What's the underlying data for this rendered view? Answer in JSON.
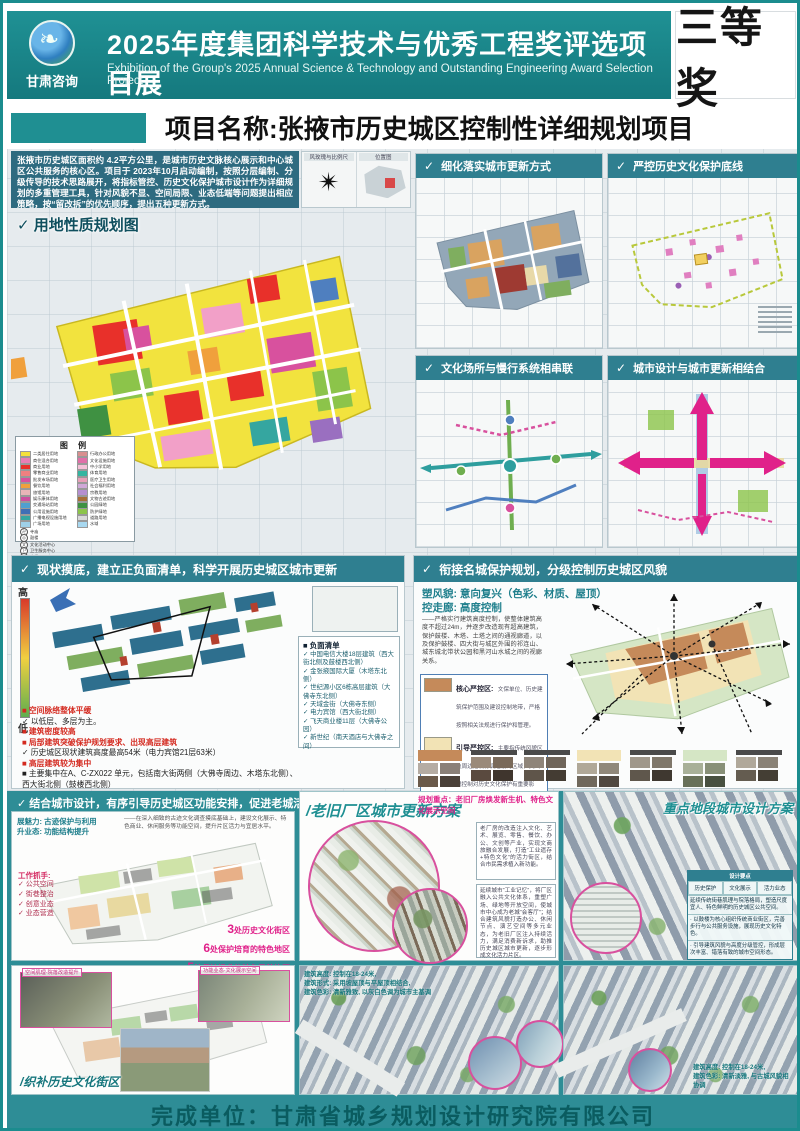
{
  "ui": {
    "check": "✓",
    "slash": "/"
  },
  "header": {
    "logo_text": "甘肃咨询",
    "title": "2025年度集团科学技术与优秀工程奖评选项目展",
    "subtitle": "Exhibition of the Group's 2025 Annual Science & Technology and Outstanding Engineering Award Selection Project",
    "award": "三等奖"
  },
  "project": {
    "title": "项目名称:张掖市历史城区控制性详细规划项目",
    "intro": "张掖市历史城区面积约 4.2平方公里，是城市历史文脉核心展示和中心城区公共服务的核心区。项目于 2023年10月启动编制，按照分层编制、分级传导的技术思路展开，将指标管控、历史文化保护城市设计作为详细规划的多重管理工具，针对风貌不显、空间局限、业态低端等问题提出相应策略，按“留改拆”的优先顺序，提出五种更新方式。",
    "windrose_label": "风玫瑰与比例尺",
    "location_label": "位置图"
  },
  "land_use": {
    "title": "用地性质规划图",
    "legend_title": "图 例",
    "legend_left": [
      {
        "color": "#f5e13a",
        "label": "二类居住用地"
      },
      {
        "color": "#e87fb4",
        "label": "商住混合用地"
      },
      {
        "color": "#e8302a",
        "label": "商业用地"
      },
      {
        "color": "#f08080",
        "label": "零售商业用地"
      },
      {
        "color": "#d8519e",
        "label": "批发市场用地"
      },
      {
        "color": "#f0a03c",
        "label": "餐饮用地"
      },
      {
        "color": "#e8b4b8",
        "label": "旅馆用地"
      },
      {
        "color": "#cc4fa0",
        "label": "娱乐康体用地"
      },
      {
        "color": "#4f9fd0",
        "label": "交通场站用地"
      },
      {
        "color": "#3f6fb5",
        "label": "公用设施用地"
      },
      {
        "color": "#35a6a0",
        "label": "广播电视设施用地"
      },
      {
        "color": "#9fd0e8",
        "label": "广场用地"
      }
    ],
    "legend_right": [
      {
        "color": "#d88f8f",
        "label": "行政办公用地"
      },
      {
        "color": "#e06fa8",
        "label": "文化设施用地"
      },
      {
        "color": "#f5c0d8",
        "label": "中小学用地"
      },
      {
        "color": "#35b5a0",
        "label": "体育用地"
      },
      {
        "color": "#e89fb8",
        "label": "医疗卫生用地"
      },
      {
        "color": "#d0a8d8",
        "label": "社会福利用地"
      },
      {
        "color": "#b58fd0",
        "label": "宗教用地"
      },
      {
        "color": "#a86f38",
        "label": "文物古迹用地"
      },
      {
        "color": "#3f9142",
        "label": "公园绿地"
      },
      {
        "color": "#8cc44a",
        "label": "防护绿地"
      },
      {
        "color": "#d9d9d9",
        "label": "道路用地"
      },
      {
        "color": "#a8d8f0",
        "label": "水域"
      }
    ],
    "legend_symbols": [
      {
        "glyph": "卍",
        "label": "寺庙"
      },
      {
        "glyph": "◎",
        "label": "鼓楼"
      },
      {
        "glyph": "文",
        "label": "文化活动中心"
      },
      {
        "glyph": "卫",
        "label": "卫生服务中心"
      },
      {
        "glyph": "小",
        "label": "小学"
      },
      {
        "glyph": "P",
        "label": "社会停车场"
      }
    ]
  },
  "panels": {
    "refine_title": "细化落实城市更新方式",
    "strict_title": "严控历史文化保护底线",
    "culture_title": "文化场所与慢行系统相串联",
    "design_title": "城市设计与城市更新相结合"
  },
  "status": {
    "title": "现状摸底，建立正负面清单，科学开展历史城区城市更新",
    "grad_high": "高",
    "grad_low": "低",
    "negative_title": "负面清单",
    "negative_list": [
      "中国电信大楼18层建筑（西大街北侧及鼓楼西北侧）",
      "金张掖国际大厦（木塔东北侧）",
      "世纪源小区6栋高层建筑（大佛寺东北侧）",
      "天域金街（大佛寺东侧）",
      "电力宾馆（西大街北侧）",
      "飞天商业楼11层（大佛寺公园）",
      "新世纪（南天酒店与大佛寺之间）"
    ],
    "findings": [
      {
        "type": "red",
        "text": "空间脉络整体平缓"
      },
      {
        "type": "check",
        "text": "以低层、多层为主。"
      },
      {
        "type": "red",
        "text": "建筑密度较高"
      },
      {
        "type": "red",
        "text": "局部建筑突破保护规划要求、出现高层建筑"
      },
      {
        "type": "check",
        "text": "历史城区现状建筑高度最高54米（电力宾馆21层63米）"
      },
      {
        "type": "red",
        "text": "高层建筑较为集中"
      },
      {
        "type": "black",
        "text": "主要集中在A、C-ZX022 单元，包括南大街两侧（大佛寺周边、木塔东北侧）、西大街北侧（鼓楼西北侧）"
      }
    ]
  },
  "style": {
    "title": "衔接名城保护规划，分级控制历史城区风貌",
    "line1": "塑风貌: 意向复兴（色彩、材质、屋顶）",
    "line2": "控走廊: 高度控制",
    "paragraph": "——严格实行建筑高度控制，使整体建筑高度不超过24m，并逐步改造现有超高建筑，保护鼓楼、木塔、土塔之间的通视廊道，以及保护鼓楼、四大街与城区外围的祁连山、城东城北带状公园和黑河山水城之间的视廊关系。",
    "legend": [
      {
        "color": "#c58a5a",
        "name": "核心严控区:",
        "desc": "文保单位、历史建筑保护范围及建设控制地带，严格按照相关法规进行保护和管理。"
      },
      {
        "color": "#f2e3b5",
        "name": "引导严控区:",
        "desc": "主要指传统风貌区及周边建设协调过渡的区域，其风貌控制对历史文化保护有重要影响。"
      },
      {
        "color": "#d5e6c5",
        "name": "一般控制区:",
        "desc": ""
      }
    ],
    "swatch_groups": [
      {
        "label": "核心严控区",
        "lead": "#c58a5a",
        "colors": [
          "#b5aca3",
          "#8a8078",
          "#6b5a4a",
          "#4a4038"
        ]
      },
      {
        "label": "",
        "lead": "",
        "colors": [
          "#9a8a7a",
          "#7a6a5a",
          "#5a4a3f",
          "#3f352d"
        ]
      },
      {
        "label": "",
        "lead": "",
        "colors": [
          "#8f857a",
          "#6f655a",
          "#5f554a",
          "#443c33"
        ]
      },
      {
        "label": "引导严控区",
        "lead": "#f2e3b5",
        "colors": [
          "#b0a898",
          "#90887a",
          "#70685c",
          "#504840"
        ]
      },
      {
        "label": "",
        "lead": "",
        "colors": [
          "#9f978a",
          "#7f776a",
          "#5f574c",
          "#3f3830"
        ]
      },
      {
        "label": "一般控制区",
        "lead": "#d5e6c5",
        "colors": [
          "#a8b098",
          "#889078",
          "#687058",
          "#485040"
        ]
      },
      {
        "label": "",
        "lead": "",
        "colors": [
          "#b0a89a",
          "#8a8276",
          "#645c50",
          "#443e34"
        ]
      }
    ]
  },
  "vitality": {
    "title": "结合城市设计，有序引导历史城区功能安排，促进老城活力发展",
    "tag1": "展魅力: 古迹保护与利用",
    "tag2": "升业态: 功能结构提升",
    "note": "——在深入细致的古迹文化调查摸底基础上，建设文化展示、特色商业、休闲服务等功能空间，提升片区活力与宜居水平。",
    "handles_title": "工作抓手:",
    "handles": [
      "公共空间",
      "街巷整治",
      "创意业态",
      "业态营造"
    ],
    "stats": [
      {
        "num": "3",
        "text": "处历史文化街区"
      },
      {
        "num": "6",
        "text": "处保护培育的特色地区"
      },
      {
        "num": "5",
        "text": "处保护提升的特色风貌片区"
      }
    ],
    "inset_cap1": "空间肌理·院落改造提升",
    "inset_cap2": "功能业态·文化展示空间",
    "block_label": "织补历史文化街区"
  },
  "factory": {
    "title": "老旧厂区城市更新方案",
    "key": "规划重点：老旧厂房焕发新生机、特色文化展示空间",
    "para1": "老厂房的改造注入文化、艺术、展览、零售、餐饮、办公、文创等产业，实现文商旅融合发展，打造“工业遗存+特色文化”的活力街区，结合市民需求植入新功能。",
    "para2": "延续城市“工业记忆”，将厂区融入公共文化体系，重塑广场、绿地等开放空间，使城市中心成为老城“会客厅”；结合建筑风貌打造办公、休闲节点、演艺空间等多元业态，为老旧厂区注入持续活力，满足消费新诉求，助推历史城区城市更新，逐步形成文化活力片区。",
    "notes": [
      "建筑高度: 控制在18-24米,",
      "建筑形式: 采用坡屋顶与平屋顶相结合,",
      "建筑色彩: 清新雅致, 以灰白色调为城市主基调"
    ]
  },
  "keyarea": {
    "title": "重点地段城市设计方案",
    "table_title": "设计要点",
    "table_cols": [
      "历史保护",
      "文化展示",
      "活力业态"
    ],
    "table_note": "延续传统街巷肌理与院落格局，塑造尺度宜人、特色鲜明的历史城区公共空间。",
    "bullet1": "· 以鼓楼为核心组织传统商业街区，完善步行与公共服务设施，展现历史文化特色。",
    "bullet2": "· 引导建筑风貌与高度分级管控，形成层次丰富、错落有致的城市空间形态。",
    "notes": [
      "建筑高度: 控制在18-24米,",
      "建筑色彩: 清新淡雅, 与古城风貌相协调"
    ]
  },
  "footer": {
    "text": "完成单位：甘肃省城乡规划设计研究院有限公司"
  }
}
